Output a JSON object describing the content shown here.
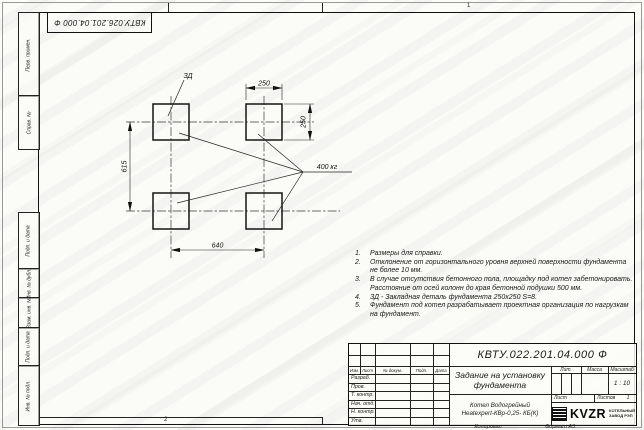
{
  "sheet": {
    "top_stamp": "КВТУ.026.201.04.000 Ф",
    "zone_top": "1",
    "zone_bottom": "2"
  },
  "margin_labels": [
    "Перв. примен.",
    "Справ. №",
    "Подп. и дата",
    "Инв. № дубл.",
    "Взам. инв. №",
    "Подп. и дата",
    "Инв. № подл."
  ],
  "drawing": {
    "detail_label": "ЗД",
    "load_label": "400 кг",
    "dim_top": "250",
    "dim_right": "250",
    "dim_left": "615",
    "dim_bottom": "640"
  },
  "notes": [
    {
      "num": "1.",
      "text": "Размеры для справки."
    },
    {
      "num": "2.",
      "text": "Отклонение от горизонтального уровня верхней поверхности фундамента не более 10 мм."
    },
    {
      "num": "3.",
      "text": "В случае отсутствия бетонного пола, площадку под котел забетонировать. Расстояние от осей колонн до края бетонной подушки 500 мм."
    },
    {
      "num": "4.",
      "text": "ЗД - Закладная деталь фундамента 250х250 S=8."
    },
    {
      "num": "5.",
      "text": "Фундамент под котел разрабатывает проектная организация по нагрузкам на фундамент."
    }
  ],
  "title_block": {
    "designation": "КВТУ.022.201.04.000 Ф",
    "title_line1": "Задание на установку",
    "title_line2": "фундамента",
    "header_cols": [
      "Изм.",
      "Лист",
      "№ докум.",
      "Подп.",
      "Дата"
    ],
    "rows": [
      "Разраб.",
      "Пров.",
      "Т. контр.",
      "Нач. отд.",
      "Н. контр.",
      "Утв."
    ],
    "lit_label": "Лит.",
    "mass_label": "Масса",
    "scale_label": "Масштаб",
    "scale_value": "1 : 10",
    "sheet_label": "Лист",
    "sheets_label": "Листов",
    "sheets_value": "1",
    "product_line1": "Котел Водогрейный",
    "product_line2": "Heatexpert-КВр-0,25- КБ(К)",
    "logo_text": "KVZR",
    "logo_sub1": "КОТЕЛЬНЫЙ",
    "logo_sub2": "ЗАВОД РЭП",
    "copied_label": "Копировал",
    "format_label": "Формат А3"
  },
  "colors": {
    "line": "#1b1b1b",
    "paper": "#fbfbf8"
  }
}
